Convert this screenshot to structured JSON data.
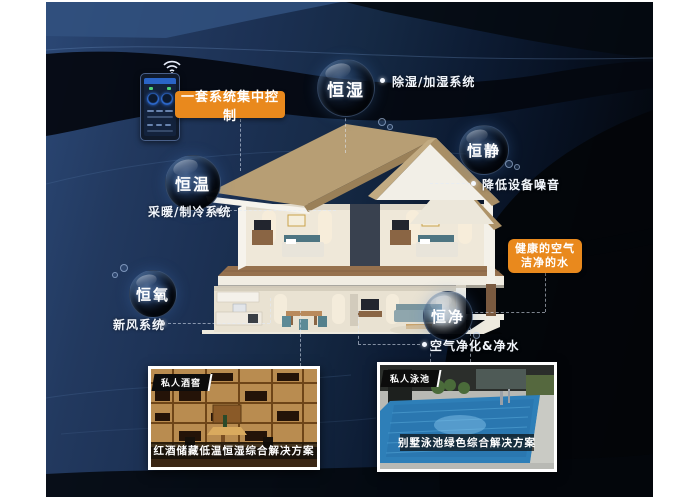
{
  "control": {
    "label": "一套系统集中控制",
    "device": "smart-home-control-panel",
    "icon": "wifi-icon"
  },
  "features": [
    {
      "name": "恒湿",
      "callout": "除湿/加湿系统"
    },
    {
      "name": "恒静",
      "callout": "降低设备噪音"
    },
    {
      "name": "恒温",
      "callout": "采暖/制冷系统"
    },
    {
      "name": "恒氧",
      "callout": "新风系统"
    },
    {
      "name": "恒净",
      "callout": "空气净化&净水"
    }
  ],
  "highlight": {
    "line1": "健康的空气",
    "line2": "洁净的水"
  },
  "solutions": [
    {
      "tag": "私人酒窖",
      "caption": "红酒储藏低温恒湿综合解决方案"
    },
    {
      "tag": "私人泳池",
      "caption": "别墅泳池绿色综合解决方案"
    }
  ],
  "colors": {
    "accent_orange": "#e9891d",
    "background_navy": "#1c3154",
    "background_black": "#04070d",
    "text_white": "#ffffff"
  }
}
